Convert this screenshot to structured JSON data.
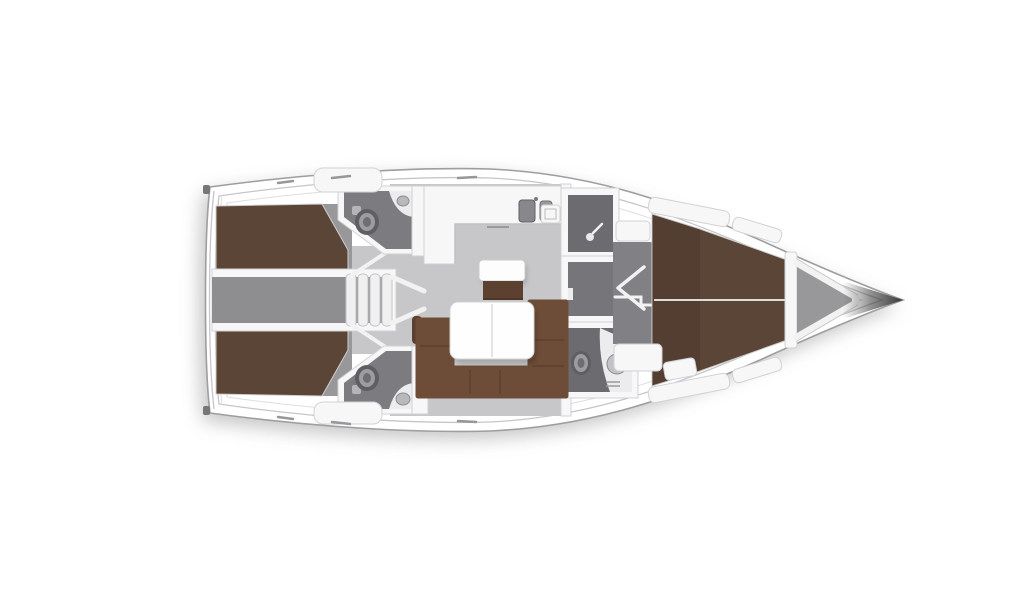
{
  "meta": {
    "title": "Sailing yacht interior floor plan — top-down deck view, bow pointing right",
    "diagram_type": "boat-floor-plan",
    "orientation": "bow-right"
  },
  "colors": {
    "background": "#ffffff",
    "hull_fill": "#ffffff",
    "hull_outline": "#9e9ea1",
    "deck_line": "#c6c6c8",
    "wall_white": "#f7f7f8",
    "wall_edge": "#d2d2d4",
    "floor_light": "#c7c7c9",
    "floor_mid": "#98989b",
    "floor_dark": "#7c7c80",
    "corridor_gray": "#8e8e91",
    "room_dark": "#6c6c70",
    "bed_brown": "#5a4537",
    "sofa_brown": "#6d4d38",
    "sofa_seam": "#53392a",
    "cabinet_brown": "#5c4130",
    "fixture_light": "#ececee",
    "fixture_mid": "#b5b5b7",
    "fixture_dark": "#5f5f63",
    "tip_dark": "#2e2e2e"
  },
  "rooms": [
    {
      "id": "aft-cabin-port",
      "label": "Aft double cabin, port side"
    },
    {
      "id": "aft-cabin-starboard",
      "label": "Aft double cabin, starboard side"
    },
    {
      "id": "aft-head-port",
      "label": "Aft head with toilet and corner basin, port"
    },
    {
      "id": "aft-head-starboard",
      "label": "Aft head with toilet and corner basin, starboard"
    },
    {
      "id": "companionway",
      "label": "Companionway steps and passage between aft cabins"
    },
    {
      "id": "galley",
      "label": "L-shaped galley with twin sinks"
    },
    {
      "id": "salon",
      "label": "Salon with U-shaped settee, table and island seat"
    },
    {
      "id": "forward-shower",
      "label": "Forward shower compartment"
    },
    {
      "id": "forward-head",
      "label": "Forward head with toilet and corner basin"
    },
    {
      "id": "forward-cabin",
      "label": "Forward V-berth double cabin"
    },
    {
      "id": "anchor-locker",
      "label": "Bow anchor locker"
    }
  ]
}
